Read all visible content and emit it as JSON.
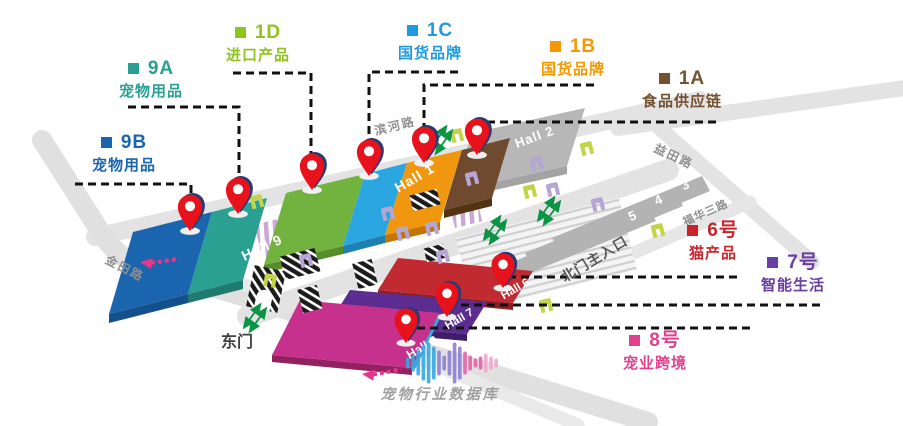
{
  "areas": {
    "a9b": {
      "code": "9B",
      "label": "宠物用品",
      "color": "#1b65ae"
    },
    "a9a": {
      "code": "9A",
      "label": "宠物用品",
      "color": "#2aa093"
    },
    "a1d": {
      "code": "1D",
      "label": "进口产品",
      "color": "#8fc31f"
    },
    "a1c": {
      "code": "1C",
      "label": "国货品牌",
      "color": "#1e9ae0"
    },
    "a1b": {
      "code": "1B",
      "label": "国货品牌",
      "color": "#f39800"
    },
    "a1a": {
      "code": "1A",
      "label": "食品供应链",
      "color": "#74512f"
    },
    "a6": {
      "code": "6号",
      "label": "猫产品",
      "color": "#c9242b"
    },
    "a7": {
      "code": "7号",
      "label": "智能生活",
      "color": "#6a3da5"
    },
    "a8": {
      "code": "8号",
      "label": "宠业跨境",
      "color": "#e2408f"
    }
  },
  "halls": {
    "h9": "Hall 9",
    "h1": "Hall 1",
    "h2": "Hall 2",
    "h3": "3",
    "h4": "4",
    "h5": "5",
    "h6": "Hall 6",
    "h7": "Hall 7",
    "h8": "Hall 8"
  },
  "roads": {
    "binhe": "滨河路",
    "yitian": "益田路",
    "jintian": "金田路",
    "fuhua": "福华三路"
  },
  "entrances": {
    "east": "东门",
    "north": "北门主入口"
  },
  "watermark": "宠物行业数据库",
  "colors": {
    "hall_9b": "#1b65ae",
    "hall_9a": "#2aa093",
    "hall_1d": "#72b23e",
    "hall_1c": "#2aa7e0",
    "hall_1b": "#f0970f",
    "hall_1a": "#6f4a2e",
    "hall_gray": "#b7b7b8",
    "hall_6": "#c02a30",
    "hall_7": "#5c2d90",
    "hall_8": "#c7318e",
    "road": "#e3e3e4",
    "pin_red": "#e8121c",
    "pin_navy": "#2a3b72",
    "arrow_green": "#0b9444",
    "arrow_pink": "#e5358f",
    "leader_line": "#111111",
    "watermark_gray": "#9fa0a0"
  }
}
